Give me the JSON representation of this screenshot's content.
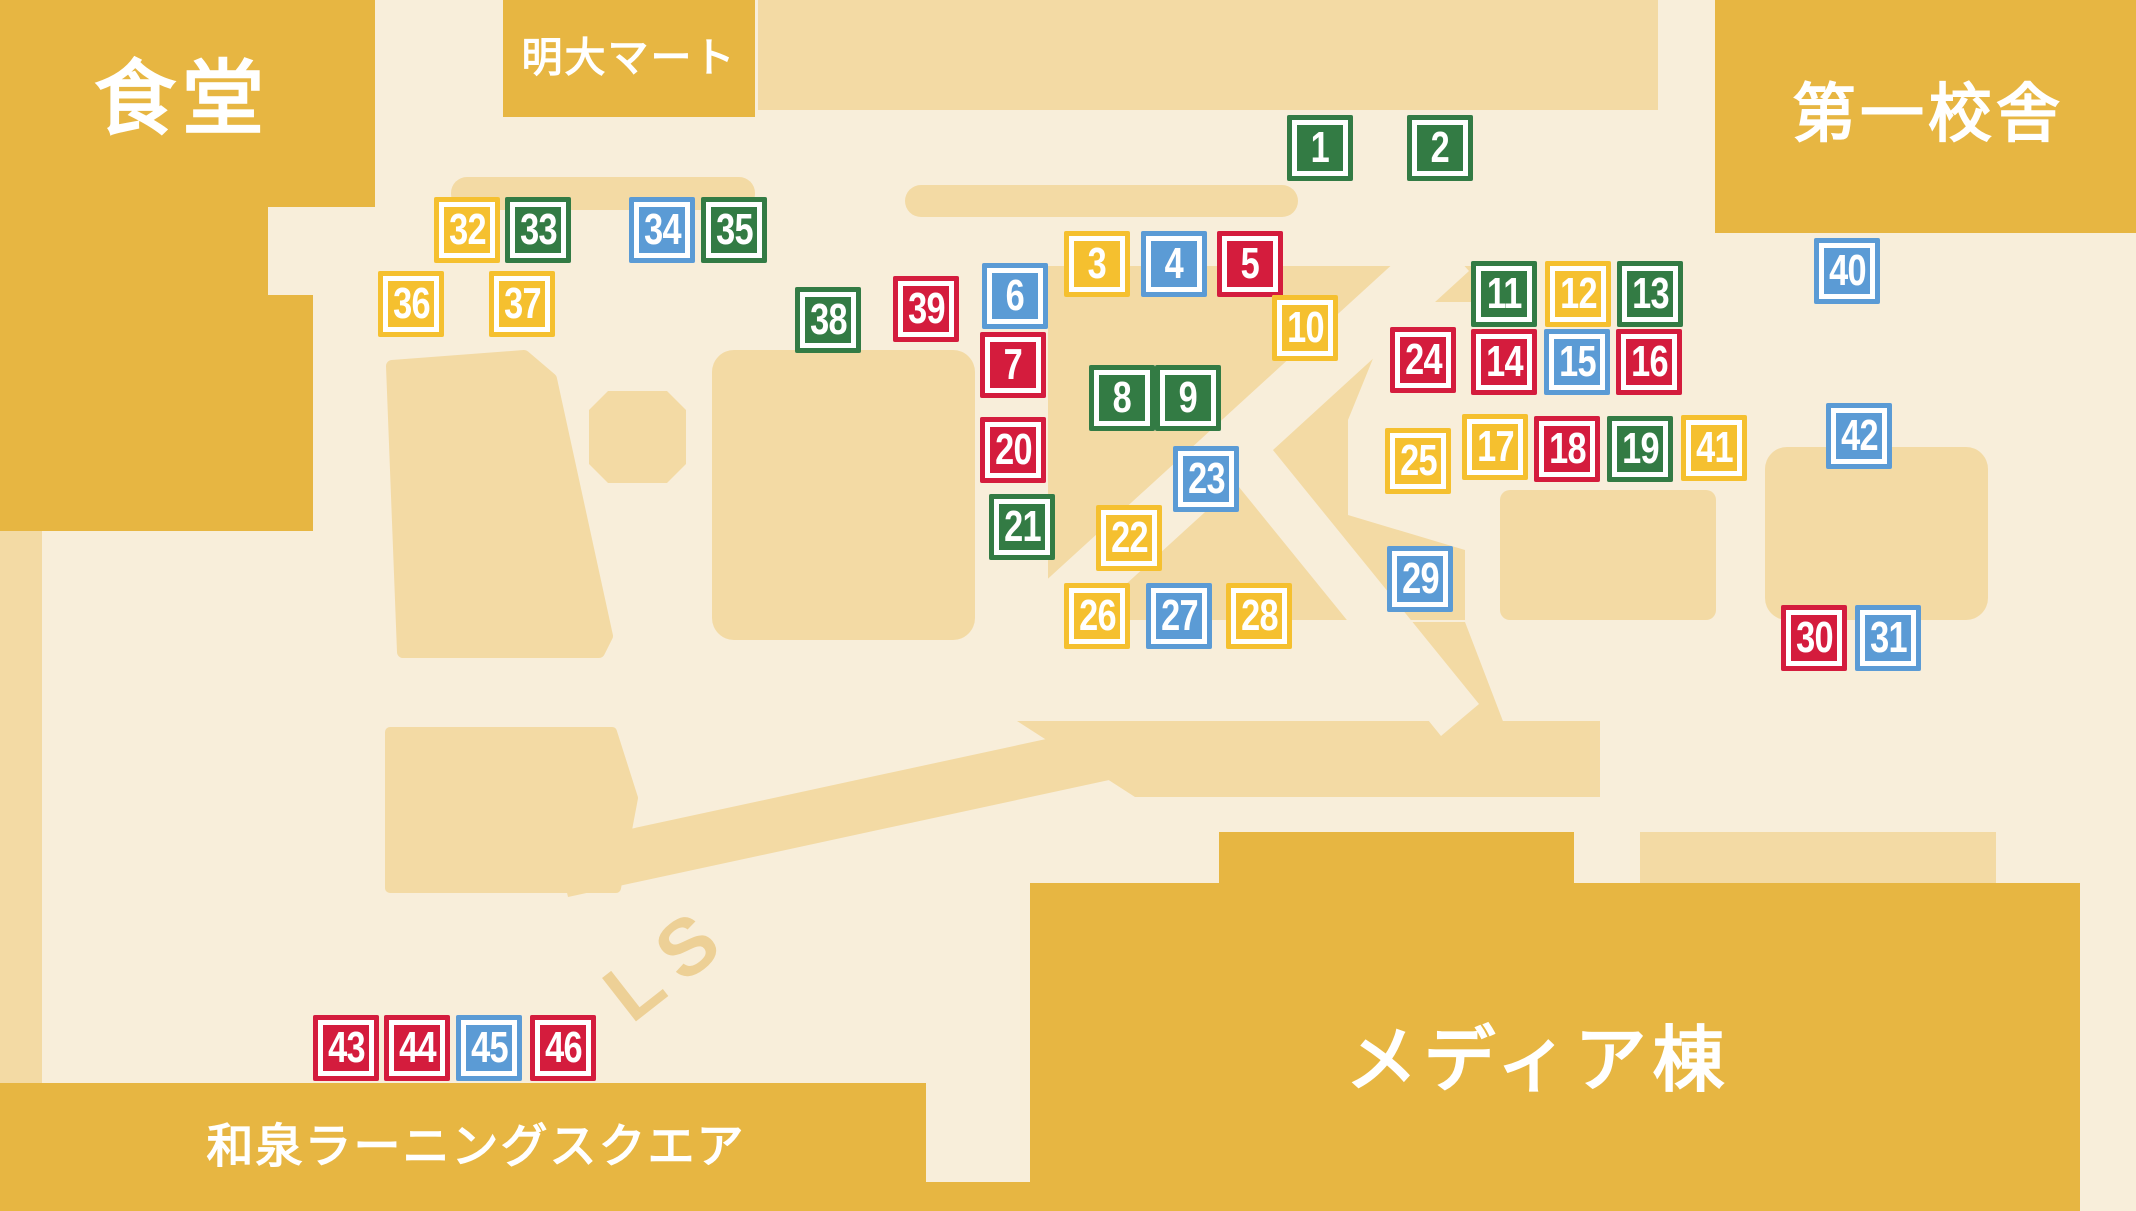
{
  "map": {
    "palette": {
      "cream": "#F8EEDA",
      "tan": "#F3DAA4",
      "tan_dark": "#EDD096",
      "gold": "#E7B642",
      "white": "#FFFFFF",
      "marker_colors": {
        "green": "#337B44",
        "yellow": "#F5C02F",
        "red": "#D41C3D",
        "blue": "#5B9BD5"
      }
    },
    "buildings": {
      "cafeteria": {
        "label": "食堂"
      },
      "meidai_mart": {
        "label": "明大マート"
      },
      "first_school_building": {
        "label": "第一校舎"
      },
      "media_building": {
        "label": "メディア棟"
      },
      "izumi_learning_square": {
        "label": "和泉ラーニングスクエア"
      }
    },
    "path_label": "LS",
    "markers": [
      {
        "n": "1",
        "color": "green",
        "x": 1320,
        "y": 148
      },
      {
        "n": "2",
        "color": "green",
        "x": 1440,
        "y": 148
      },
      {
        "n": "3",
        "color": "yellow",
        "x": 1097,
        "y": 264
      },
      {
        "n": "4",
        "color": "blue",
        "x": 1174,
        "y": 264
      },
      {
        "n": "5",
        "color": "red",
        "x": 1250,
        "y": 264
      },
      {
        "n": "6",
        "color": "blue",
        "x": 1015,
        "y": 296
      },
      {
        "n": "7",
        "color": "red",
        "x": 1013,
        "y": 365
      },
      {
        "n": "8",
        "color": "green",
        "x": 1122,
        "y": 398
      },
      {
        "n": "9",
        "color": "green",
        "x": 1188,
        "y": 398
      },
      {
        "n": "10",
        "color": "yellow",
        "x": 1305,
        "y": 328
      },
      {
        "n": "11",
        "color": "green",
        "x": 1504,
        "y": 294
      },
      {
        "n": "12",
        "color": "yellow",
        "x": 1578,
        "y": 294
      },
      {
        "n": "13",
        "color": "green",
        "x": 1650,
        "y": 294
      },
      {
        "n": "14",
        "color": "red",
        "x": 1504,
        "y": 362
      },
      {
        "n": "15",
        "color": "blue",
        "x": 1577,
        "y": 362
      },
      {
        "n": "16",
        "color": "red",
        "x": 1649,
        "y": 362
      },
      {
        "n": "17",
        "color": "yellow",
        "x": 1495,
        "y": 447
      },
      {
        "n": "18",
        "color": "red",
        "x": 1567,
        "y": 449
      },
      {
        "n": "19",
        "color": "green",
        "x": 1640,
        "y": 449
      },
      {
        "n": "20",
        "color": "red",
        "x": 1013,
        "y": 450
      },
      {
        "n": "21",
        "color": "green",
        "x": 1022,
        "y": 527
      },
      {
        "n": "22",
        "color": "yellow",
        "x": 1129,
        "y": 538
      },
      {
        "n": "23",
        "color": "blue",
        "x": 1206,
        "y": 479
      },
      {
        "n": "24",
        "color": "red",
        "x": 1423,
        "y": 360
      },
      {
        "n": "25",
        "color": "yellow",
        "x": 1418,
        "y": 461
      },
      {
        "n": "26",
        "color": "yellow",
        "x": 1097,
        "y": 616
      },
      {
        "n": "27",
        "color": "blue",
        "x": 1179,
        "y": 616
      },
      {
        "n": "28",
        "color": "yellow",
        "x": 1259,
        "y": 616
      },
      {
        "n": "29",
        "color": "blue",
        "x": 1420,
        "y": 579
      },
      {
        "n": "30",
        "color": "red",
        "x": 1814,
        "y": 638
      },
      {
        "n": "31",
        "color": "blue",
        "x": 1888,
        "y": 638
      },
      {
        "n": "32",
        "color": "yellow",
        "x": 467,
        "y": 230
      },
      {
        "n": "33",
        "color": "green",
        "x": 538,
        "y": 230
      },
      {
        "n": "34",
        "color": "blue",
        "x": 662,
        "y": 230
      },
      {
        "n": "35",
        "color": "green",
        "x": 734,
        "y": 230
      },
      {
        "n": "36",
        "color": "yellow",
        "x": 411,
        "y": 304
      },
      {
        "n": "37",
        "color": "yellow",
        "x": 522,
        "y": 304
      },
      {
        "n": "38",
        "color": "green",
        "x": 828,
        "y": 320
      },
      {
        "n": "39",
        "color": "red",
        "x": 926,
        "y": 309
      },
      {
        "n": "40",
        "color": "blue",
        "x": 1847,
        "y": 271
      },
      {
        "n": "41",
        "color": "yellow",
        "x": 1714,
        "y": 448
      },
      {
        "n": "42",
        "color": "blue",
        "x": 1859,
        "y": 436
      },
      {
        "n": "43",
        "color": "red",
        "x": 346,
        "y": 1048
      },
      {
        "n": "44",
        "color": "red",
        "x": 417,
        "y": 1048
      },
      {
        "n": "45",
        "color": "blue",
        "x": 489,
        "y": 1048
      },
      {
        "n": "46",
        "color": "red",
        "x": 563,
        "y": 1048
      }
    ]
  }
}
